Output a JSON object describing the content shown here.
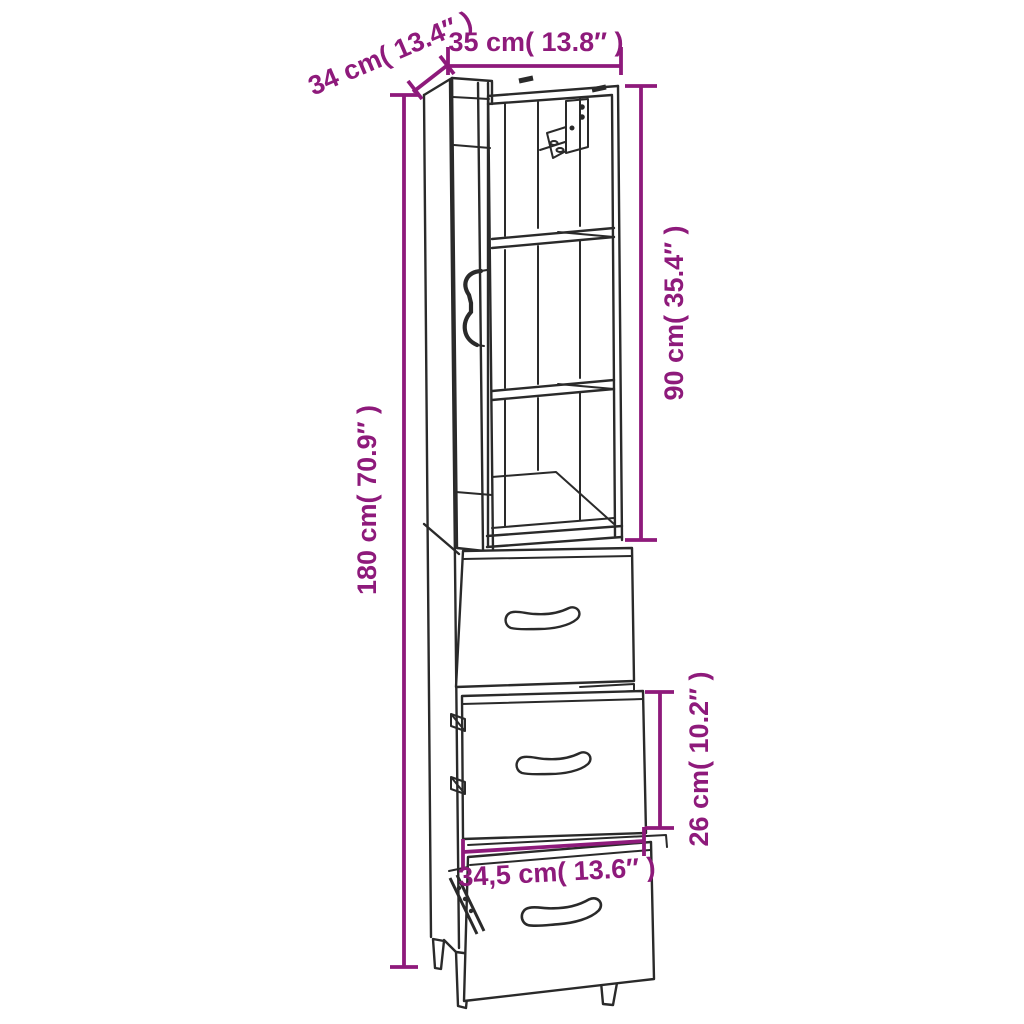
{
  "diagram": {
    "kind": "furniture-dimension-diagram",
    "subject": "Tall cabinet with open glass door, two shelves, wall-mount bracket and three pull-out drawers",
    "colors": {
      "background": "#ffffff",
      "line": "#2a2a2a",
      "dimension": "#8E1A7B"
    },
    "dimensions": [
      {
        "id": "depth",
        "label": "34 cm( 13.4″ )",
        "value_cm": "34",
        "value_inch": "13.4",
        "orientation": "diagonal"
      },
      {
        "id": "width",
        "label": "35 cm( 13.8″ )",
        "value_cm": "35",
        "value_inch": "13.8",
        "orientation": "horizontal"
      },
      {
        "id": "upper_height",
        "label": "90 cm( 35.4″ )",
        "value_cm": "90",
        "value_inch": "35.4",
        "orientation": "vertical"
      },
      {
        "id": "total_height",
        "label": "180 cm( 70.9″ )",
        "value_cm": "180",
        "value_inch": "70.9",
        "orientation": "vertical"
      },
      {
        "id": "drawer_height",
        "label": "26 cm( 10.2″ )",
        "value_cm": "26",
        "value_inch": "10.2",
        "orientation": "vertical"
      },
      {
        "id": "drawer_width",
        "label": "34,5 cm( 13.6″ )",
        "value_cm": "34,5",
        "value_inch": "13.6",
        "orientation": "horizontal"
      }
    ]
  }
}
